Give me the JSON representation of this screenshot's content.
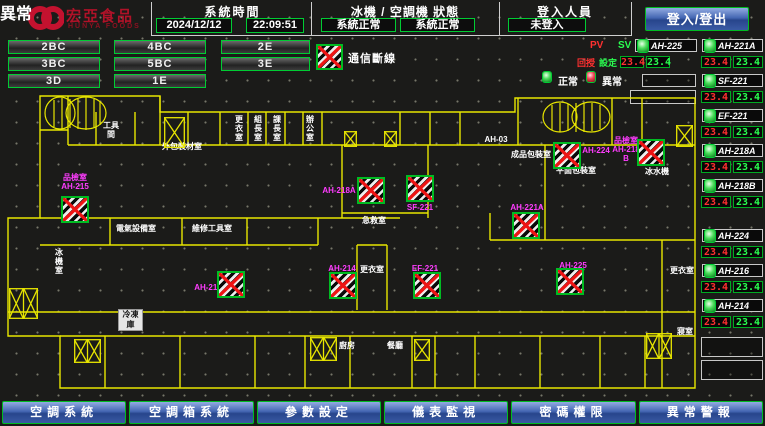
{
  "colors": {
    "accent_green": "#00cc33",
    "wall_yellow": "#e8e600",
    "alarm_red": "#ee1414",
    "label_magenta": "#ff3cff",
    "pv_red": "#ff3030",
    "sv_green": "#2aff50",
    "button_blue": "#3f63b0",
    "brand_red": "#c4122f"
  },
  "header": {
    "brand": "宏亞食品",
    "brand_sub": "HUNYA FOODS",
    "time_section": {
      "label": "系統時間",
      "date": "2024/12/12",
      "time": "22:09:51"
    },
    "status_section": {
      "label": "冰機 / 空調機 狀態",
      "chiller_status": "系統正常",
      "ahu_status": "系統正常"
    },
    "login_section": {
      "label": "登入人員",
      "status": "未登入",
      "login_button": "登入/登出"
    }
  },
  "zone_buttons": [
    "2BC",
    "4BC",
    "2E",
    "3BC",
    "5BC",
    "3E",
    "3D",
    "1E"
  ],
  "legend": {
    "comm_loss": "通信斷線",
    "normal": "正常",
    "abnormal": "異常",
    "pv_label": "PV",
    "sv_label": "SV",
    "pv_cn": "回授",
    "sv_cn": "設定"
  },
  "status_list": {
    "featured": {
      "name": "AH-225",
      "pv": "23.4",
      "sv": "23.4"
    },
    "items": [
      {
        "name": "AH-221A",
        "pv": "23.4",
        "sv": "23.4"
      },
      {
        "name": "SF-221",
        "pv": "23.4",
        "sv": "23.4"
      },
      {
        "name": "EF-221",
        "pv": "23.4",
        "sv": "23.4"
      },
      {
        "name": "AH-218A",
        "pv": "23.4",
        "sv": "23.4"
      },
      {
        "name": "AH-218B",
        "pv": "23.4",
        "sv": "23.4"
      },
      {
        "name": "AH-224",
        "pv": "23.4",
        "sv": "23.4"
      },
      {
        "name": "AH-216",
        "pv": "23.4",
        "sv": "23.4"
      },
      {
        "name": "AH-214",
        "pv": "23.4",
        "sv": "23.4"
      }
    ],
    "empty_slots": 2
  },
  "map": {
    "rooms": [
      {
        "text": "工具間",
        "x": 101,
        "y": 121,
        "w": 20
      },
      {
        "text": "外包裝材室",
        "x": 160,
        "y": 142,
        "w": 44
      },
      {
        "text": "更衣室",
        "x": 234,
        "y": 115,
        "w": 10
      },
      {
        "text": "組長室",
        "x": 253,
        "y": 115,
        "w": 10
      },
      {
        "text": "課長室",
        "x": 272,
        "y": 115,
        "w": 10
      },
      {
        "text": "辦公室",
        "x": 305,
        "y": 115,
        "w": 10
      },
      {
        "text": "AH-03",
        "x": 482,
        "y": 135,
        "w": 28
      },
      {
        "text": "成品包裝室",
        "x": 505,
        "y": 150,
        "w": 52
      },
      {
        "text": "平面包裝室",
        "x": 556,
        "y": 166,
        "w": 40
      },
      {
        "text": "冰水機",
        "x": 643,
        "y": 167,
        "w": 28
      },
      {
        "text": "電氣設備室",
        "x": 114,
        "y": 224,
        "w": 44
      },
      {
        "text": "維修工具室",
        "x": 190,
        "y": 224,
        "w": 44
      },
      {
        "text": "急救室",
        "x": 361,
        "y": 216,
        "w": 26
      },
      {
        "text": "更衣室",
        "x": 359,
        "y": 265,
        "w": 26
      },
      {
        "text": "冰機室",
        "x": 54,
        "y": 248,
        "w": 10
      },
      {
        "text": "冷凍庫",
        "x": 118,
        "y": 309,
        "w": 25,
        "boxed": true
      },
      {
        "text": "廚房",
        "x": 338,
        "y": 341,
        "w": 18
      },
      {
        "text": "餐廳",
        "x": 386,
        "y": 341,
        "w": 18
      },
      {
        "text": "更衣室",
        "x": 668,
        "y": 266,
        "w": 28
      },
      {
        "text": "寢室",
        "x": 675,
        "y": 327,
        "w": 20
      }
    ],
    "equipment": [
      {
        "id": "AH-215",
        "room": "品檢室",
        "label_x": 57,
        "label_y": 173,
        "label_w": 36,
        "icon_x": 61,
        "icon_y": 196
      },
      {
        "id": "AH-218A",
        "label_x": 321,
        "label_y": 186,
        "label_w": 36,
        "icon_x": 357,
        "icon_y": 177
      },
      {
        "id": "SF-221",
        "label_x": 404,
        "label_y": 203,
        "label_w": 32,
        "icon_x": 406,
        "icon_y": 175
      },
      {
        "id": "AH-224",
        "label_x": 581,
        "label_y": 146,
        "label_w": 30,
        "icon_x": 553,
        "icon_y": 142
      },
      {
        "id": "AH-218B",
        "room": "品檢室",
        "label_x": 612,
        "label_y": 136,
        "label_w": 28,
        "icon_x": 637,
        "icon_y": 139
      },
      {
        "id": "AH-221A",
        "label_x": 509,
        "label_y": 203,
        "label_w": 36,
        "icon_x": 512,
        "icon_y": 212
      },
      {
        "id": "AH-216",
        "label_x": 192,
        "label_y": 283,
        "label_w": 32,
        "icon_x": 217,
        "icon_y": 271
      },
      {
        "id": "AH-214",
        "label_x": 325,
        "label_y": 264,
        "label_w": 34,
        "icon_x": 329,
        "icon_y": 272
      },
      {
        "id": "EF-221",
        "label_x": 410,
        "label_y": 264,
        "label_w": 30,
        "icon_x": 413,
        "icon_y": 272
      },
      {
        "id": "AH-225",
        "label_x": 558,
        "label_y": 261,
        "label_w": 30,
        "icon_x": 556,
        "icon_y": 268
      }
    ],
    "stairs": [
      {
        "x": 164,
        "y": 117,
        "w": 21,
        "h": 31,
        "cells": 1
      },
      {
        "x": 344,
        "y": 131,
        "w": 13,
        "h": 16,
        "cells": 1
      },
      {
        "x": 384,
        "y": 131,
        "w": 13,
        "h": 16,
        "cells": 1
      },
      {
        "x": 676,
        "y": 125,
        "w": 17,
        "h": 22,
        "cells": 1
      },
      {
        "x": 9,
        "y": 288,
        "w": 29,
        "h": 31,
        "cells": 2
      },
      {
        "x": 74,
        "y": 339,
        "w": 27,
        "h": 24,
        "cells": 2
      },
      {
        "x": 310,
        "y": 337,
        "w": 27,
        "h": 24,
        "cells": 2
      },
      {
        "x": 414,
        "y": 339,
        "w": 16,
        "h": 22,
        "cells": 1
      },
      {
        "x": 646,
        "y": 333,
        "w": 26,
        "h": 26,
        "cells": 2
      }
    ]
  },
  "nav_buttons": [
    {
      "label": "空調系統",
      "name": "hvac-system"
    },
    {
      "label": "空調箱系統",
      "name": "ahu-system"
    },
    {
      "label": "參數設定",
      "name": "parameter-settings"
    },
    {
      "label": "儀表監視",
      "name": "meter-monitoring"
    },
    {
      "label": "密碼權限",
      "name": "password-permission"
    },
    {
      "label": "異常警報",
      "name": "abnormal-alarm"
    }
  ]
}
